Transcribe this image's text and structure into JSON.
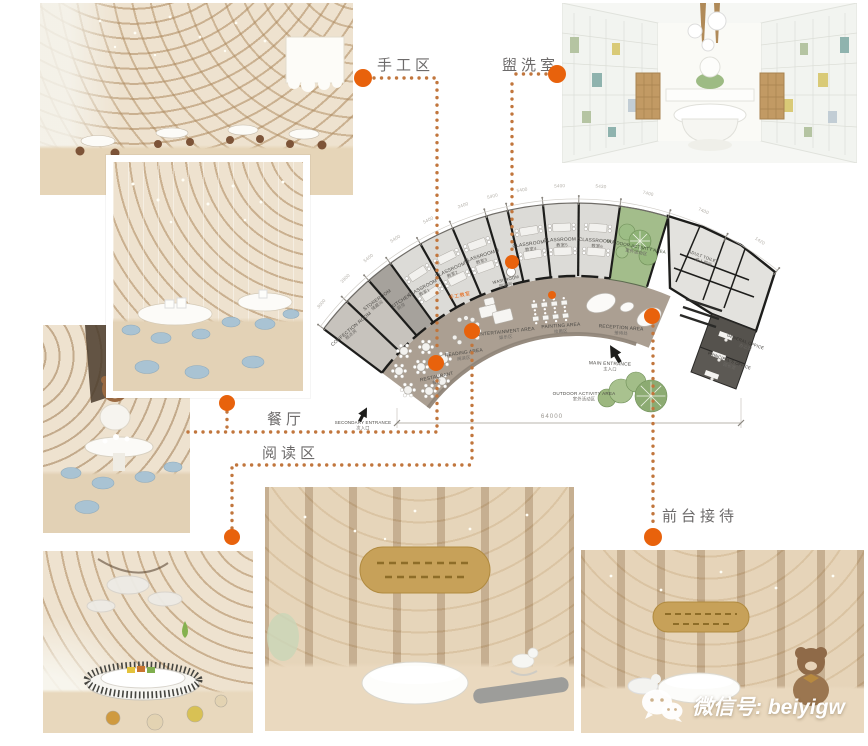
{
  "colors": {
    "accent": "#e8620c",
    "leader": "#c1763d",
    "callout_text": "#6d6b6b",
    "corridor": "#ab9f92",
    "room": "#dcdbd7",
    "room_dark": "#a6a29c",
    "room_left": "#c7c3bd",
    "green": "#a3bd8b",
    "wall": "#1d1d1b",
    "stool_blue": "#a9c3d3",
    "wood": "#c8a87e"
  },
  "callouts": [
    {
      "id": "handcraft",
      "label": "手工区"
    },
    {
      "id": "washroom",
      "label": "盥洗室"
    },
    {
      "id": "dining",
      "label": "餐厅"
    },
    {
      "id": "reading",
      "label": "阅读区"
    },
    {
      "id": "reception",
      "label": "前台接待"
    }
  ],
  "watermark": {
    "label": "微信号: beiyigw"
  },
  "plan": {
    "rooms": [
      {
        "id": "confection",
        "en": "CONFECTION ROOM",
        "zh": "糕点房"
      },
      {
        "id": "storeroom",
        "en": "STOREROOM",
        "zh": "储藏间"
      },
      {
        "id": "kitchen",
        "en": "KITCHEN",
        "zh": "厨房"
      },
      {
        "id": "classroom1",
        "en": "CLASSROOM 1",
        "zh": "教室1"
      },
      {
        "id": "classroom2",
        "en": "CLASSROOM 2",
        "zh": "教室2"
      },
      {
        "id": "classroom3",
        "en": "CLASSROOM 3",
        "zh": "教室3"
      },
      {
        "id": "washroom",
        "en": "WASHROOM",
        "zh": "盥洗间"
      },
      {
        "id": "classroom4",
        "en": "CLASSROOM 4",
        "zh": "教室4"
      },
      {
        "id": "classroom5",
        "en": "CLASSROOM 5",
        "zh": "教室5"
      },
      {
        "id": "classroom6",
        "en": "CLASSROOM 6",
        "zh": "教室6"
      },
      {
        "id": "outdoor-room",
        "en": "OUTDOOR ACTIVITY AREA",
        "zh": "室外活动区"
      },
      {
        "id": "adult-toilet",
        "en": "ADULT TOILET",
        "zh": "成人厕所"
      },
      {
        "id": "office-general",
        "en": "GENERAL OFFICE",
        "zh": "办公室"
      },
      {
        "id": "office-principal",
        "en": "PRINCIPAL'S OFFICE",
        "zh": "园长室"
      }
    ],
    "areas": [
      {
        "id": "restaurant",
        "en": "RESTAURANT",
        "zh": "餐厅"
      },
      {
        "id": "reading",
        "en": "READING AREA",
        "zh": "阅读区"
      },
      {
        "id": "entertainment",
        "en": "ENTERTAINMENT AREA",
        "zh": "娱乐区"
      },
      {
        "id": "painting",
        "en": "PAINTING AREA",
        "zh": "绘画区"
      },
      {
        "id": "reception",
        "en": "RECEPTION AREA",
        "zh": "接待处"
      },
      {
        "id": "craft-room",
        "en": "",
        "zh": "手工教室"
      }
    ],
    "entrances": [
      {
        "id": "main",
        "en": "MAIN ENTRANCE",
        "zh": "主入口"
      },
      {
        "id": "secondary",
        "en": "SECONDARY ENTRANCE",
        "zh": "次入口"
      }
    ],
    "outdoor": {
      "en": "OUTDOOR ACTIVITY AREA",
      "zh": "室外活动区"
    },
    "dimensions": {
      "total": "64000",
      "segments": [
        "3000",
        "3900",
        "5400",
        "5400",
        "5400",
        "2400",
        "5400",
        "5400",
        "5400",
        "5430",
        "7400",
        "7400",
        "1420"
      ]
    }
  }
}
